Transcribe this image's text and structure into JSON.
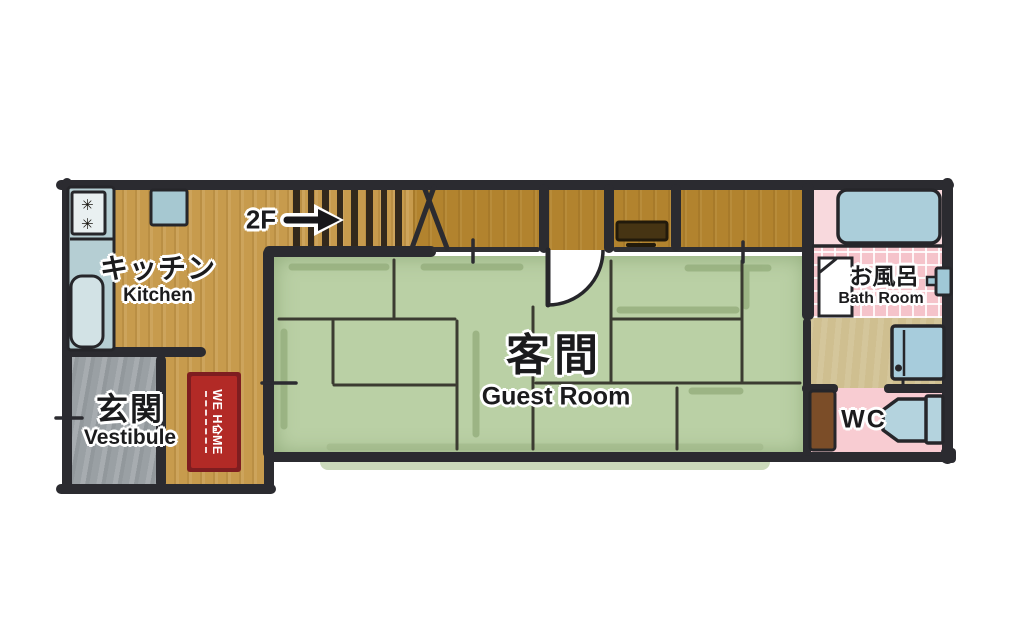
{
  "plan": {
    "type": "japanese-house-floor-plan-1F",
    "stairs": {
      "label": "2F"
    },
    "rooms": {
      "kitchen": {
        "name_ja": "キッチン",
        "name_en": "Kitchen"
      },
      "vestibule": {
        "name_ja": "玄関",
        "name_en": "Vestibule"
      },
      "guest_room": {
        "name_ja": "客間",
        "name_en": "Guest Room"
      },
      "bath_room": {
        "name_ja": "お風呂",
        "name_en": "Bath Room"
      },
      "wc": {
        "name": "WC"
      }
    },
    "rug": {
      "brand": "WE HOME",
      "brand_before_house": "WE H",
      "brand_after_house": "ME"
    },
    "stove_burner_icon": "✳",
    "fixtures": [
      "stove",
      "sink",
      "kitchen-counter",
      "wall-cabinet",
      "stairs",
      "hall-shelf",
      "bathtub",
      "shower-panel",
      "bath-door",
      "washing-machine",
      "toilet",
      "wc-door",
      "guest-room-door",
      "entry-rug"
    ]
  },
  "colors": {
    "wall": "#2b2b30",
    "wood_light": "#c79b4d",
    "wood_dark": "#b2832e",
    "tatami_green": "#bad0a5",
    "tatami_line": "#3b3b31",
    "vestibule_gray": "#9aa0a4",
    "bath_pink_light": "#f8d9dd",
    "bath_pink_tile": "#f5c3ca",
    "wc_pink": "#f8ccd2",
    "washroom_tan": "#cfbf90",
    "appliance_blue": "#abceda",
    "rug_red": "#b22a26",
    "rug_border": "#7e1d20",
    "text": "#1b1b1d"
  }
}
